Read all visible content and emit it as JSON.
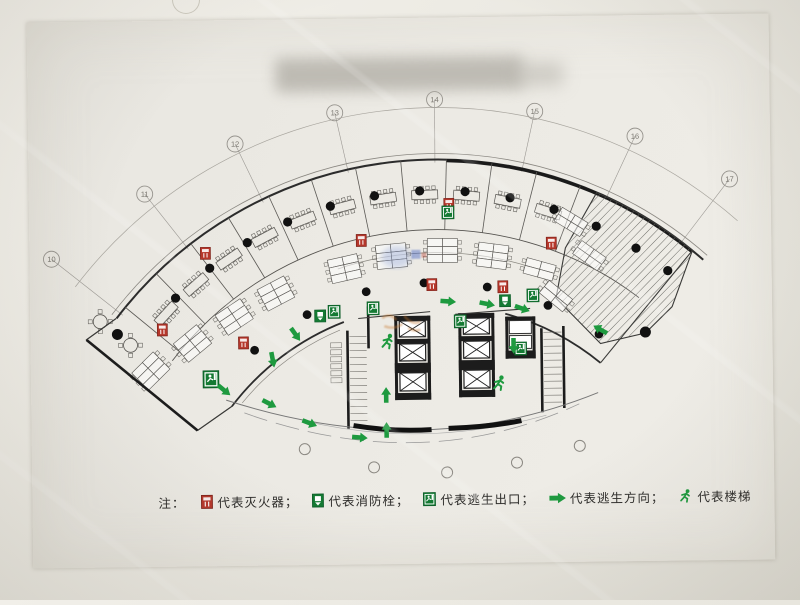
{
  "document": {
    "kind": "evacuation-floor-plan-photo",
    "title_redacted": true
  },
  "legend": {
    "note": "注：",
    "items": [
      {
        "icon": "fire-extinguisher-icon",
        "label": "代表灭火器；",
        "color": "#b5372b"
      },
      {
        "icon": "fire-hydrant-icon",
        "label": "代表消防栓；",
        "color": "#1a8a3f"
      },
      {
        "icon": "escape-exit-icon",
        "label": "代表逃生出口；",
        "color": "#1a8a3f"
      },
      {
        "icon": "escape-direction-icon",
        "label": "代表逃生方向；",
        "color": "#1e9a3f"
      },
      {
        "icon": "stairs-icon",
        "label": "代表楼梯",
        "color": "#1e9a3f"
      }
    ]
  },
  "plan": {
    "center": {
      "x": 434,
      "y": 563
    },
    "colors": {
      "line": "#4a4a4a",
      "wall": "#1c1c1c",
      "mid": "#6a6a66",
      "green": "#1e9a3f",
      "green_dark": "#147a33",
      "red": "#b5372b",
      "grid": "#9a9792",
      "watermark_orange": "#c8782e",
      "watermark_blue": "#8fa3d6"
    },
    "radii": {
      "grid_arc": 455,
      "outer_wall": 403,
      "outer_wall_outer": 409,
      "band_divider": 333,
      "spine": 310,
      "inner_wall": 258,
      "inner_wall_thin": 252,
      "columns_outer": 372,
      "columns_inner": 280
    },
    "angles": {
      "start": -52,
      "end": 42
    },
    "grid_bubbles": [
      {
        "label": "10",
        "x": 52,
        "y": 255
      },
      {
        "label": "11",
        "x": 146,
        "y": 191
      },
      {
        "label": "12",
        "x": 237,
        "y": 142
      },
      {
        "label": "13",
        "x": 337,
        "y": 112
      },
      {
        "label": "14",
        "x": 437,
        "y": 100
      },
      {
        "label": "15",
        "x": 537,
        "y": 113
      },
      {
        "label": "16",
        "x": 637,
        "y": 139
      },
      {
        "label": "17",
        "x": 731,
        "y": 183
      }
    ],
    "partition_angles": [
      -50,
      -43.5,
      -37,
      -30.5,
      -24,
      -17.5,
      -11,
      -4.5,
      2,
      8.5,
      15,
      21.5
    ],
    "meeting_angles": [
      -46.75,
      -40.25,
      -33.75,
      -27.25,
      -20.75,
      -14.25,
      -7.75,
      -1.25,
      5.25,
      11.75,
      18.25
    ],
    "outer_column_angles": [
      -44,
      -37,
      -30,
      -23,
      -16,
      -9,
      -2,
      5,
      12,
      19,
      26,
      33,
      39
    ],
    "inner_column_angles": [
      -40,
      -27,
      -14,
      -2,
      11,
      24,
      36
    ],
    "extra_columns": [
      [
        117,
        331
      ],
      [
        645,
        335
      ]
    ],
    "open_circles": [
      [
        303,
        448
      ],
      [
        372,
        467
      ],
      [
        445,
        473
      ],
      [
        515,
        464
      ],
      [
        578,
        448
      ]
    ],
    "desk_clusters": [
      {
        "x": 150,
        "y": 368,
        "rot": -44,
        "rows": 3
      },
      {
        "x": 192,
        "y": 341,
        "rot": -39,
        "rows": 3
      },
      {
        "x": 234,
        "y": 315,
        "rot": -33,
        "rows": 3
      },
      {
        "x": 276,
        "y": 292,
        "rot": -27,
        "rows": 3
      },
      {
        "x": 345,
        "y": 268,
        "rot": -12,
        "rows": 3
      },
      {
        "x": 392,
        "y": 256,
        "rot": -5,
        "rows": 3
      },
      {
        "x": 443,
        "y": 251,
        "rot": 1,
        "rows": 3
      },
      {
        "x": 493,
        "y": 257,
        "rot": 8,
        "rows": 3
      },
      {
        "x": 540,
        "y": 271,
        "rot": 16,
        "rows": 2
      },
      {
        "x": 572,
        "y": 224,
        "rot": 32,
        "rows": 2
      },
      {
        "x": 590,
        "y": 258,
        "rot": 36,
        "rows": 2
      },
      {
        "x": 556,
        "y": 298,
        "rot": 40,
        "rows": 2
      }
    ],
    "extinguishers": [
      [
        162,
        327
      ],
      [
        206,
        251
      ],
      [
        243,
        341
      ],
      [
        362,
        240
      ],
      [
        450,
        205
      ],
      [
        552,
        245
      ],
      [
        432,
        285
      ],
      [
        503,
        288
      ]
    ],
    "hydrants": [
      [
        320,
        315
      ],
      [
        505,
        302
      ]
    ],
    "exit_signs": [
      {
        "x": 210,
        "y": 377,
        "s": 1.3
      },
      {
        "x": 334,
        "y": 311,
        "s": 1
      },
      {
        "x": 373,
        "y": 308,
        "s": 1
      },
      {
        "x": 449,
        "y": 213,
        "s": 1
      },
      {
        "x": 460,
        "y": 322,
        "s": 1
      },
      {
        "x": 533,
        "y": 297,
        "s": 1
      },
      {
        "x": 520,
        "y": 350,
        "s": 1
      }
    ],
    "arrows": [
      [
        223,
        388,
        40
      ],
      [
        272,
        358,
        80
      ],
      [
        295,
        333,
        55
      ],
      [
        268,
        402,
        28
      ],
      [
        308,
        422,
        22
      ],
      [
        358,
        437,
        5
      ],
      [
        385,
        395,
        -90
      ],
      [
        385,
        430,
        -90
      ],
      [
        448,
        302,
        5
      ],
      [
        487,
        305,
        12
      ],
      [
        522,
        310,
        20
      ],
      [
        513,
        347,
        90
      ],
      [
        600,
        332,
        210
      ]
    ],
    "stair_men": [
      [
        387,
        342
      ],
      [
        498,
        385
      ]
    ],
    "elevator_boxes": [
      [
        399,
        321,
        26,
        16
      ],
      [
        399,
        344,
        26,
        17
      ],
      [
        399,
        373,
        26,
        18
      ],
      [
        463,
        319,
        26,
        16
      ],
      [
        463,
        342,
        26,
        17
      ],
      [
        463,
        371,
        26,
        18
      ]
    ],
    "shaft_boxes": [
      [
        509,
        322,
        22,
        13
      ],
      [
        509,
        337,
        22,
        13
      ]
    ],
    "black_rects": [
      [
        394,
        316,
        36,
        5
      ],
      [
        394,
        339,
        36,
        5
      ],
      [
        394,
        363,
        36,
        10
      ],
      [
        394,
        393,
        36,
        7
      ],
      [
        394,
        316,
        3,
        84
      ],
      [
        427,
        316,
        3,
        84
      ],
      [
        458,
        314,
        36,
        5
      ],
      [
        458,
        337,
        36,
        5
      ],
      [
        458,
        361,
        36,
        10
      ],
      [
        458,
        391,
        36,
        7
      ],
      [
        458,
        314,
        3,
        84
      ],
      [
        491,
        314,
        3,
        84
      ],
      [
        505,
        318,
        30,
        4
      ],
      [
        505,
        352,
        30,
        8
      ],
      [
        505,
        318,
        3,
        42
      ],
      [
        532,
        318,
        3,
        42
      ]
    ],
    "bold_lines": [
      [
        347,
        330,
        347,
        428
      ],
      [
        368,
        306,
        368,
        348
      ],
      [
        541,
        330,
        541,
        414
      ],
      [
        563,
        328,
        563,
        410
      ],
      [
        86,
        336,
        196,
        428
      ]
    ],
    "thin_lines": [
      [
        358,
        318,
        430,
        312
      ],
      [
        455,
        315,
        530,
        310
      ],
      [
        116,
        315,
        86,
        336
      ],
      [
        196,
        428,
        231,
        404
      ],
      [
        693,
        254,
        600,
        365
      ]
    ],
    "stairs": [
      {
        "x1": 349,
        "x2": 366,
        "y0": 336,
        "y1": 424,
        "step": 7
      },
      {
        "x1": 543,
        "x2": 561,
        "y0": 334,
        "y1": 408,
        "step": 7
      }
    ],
    "tread_stack": {
      "x": 330,
      "y": 342,
      "w": 11,
      "h": 5,
      "n": 6,
      "gap": 7
    },
    "hatch_path": "M598,195 A403,403 0 0 1 693,254 L672,310 L645,336 L600,346 L556,300 L566,250 Z",
    "facade_paths": [
      {
        "d": "M225,398 Q420,464 597,395",
        "c": "#777",
        "w": 1,
        "dash": ""
      },
      {
        "d": "M243,411 Q420,477 578,406",
        "c": "#999",
        "w": 0.8,
        "dash": "24 9"
      },
      {
        "d": "M300,419 Q420,450 545,417",
        "c": "#aaa",
        "w": 0.6,
        "dash": ""
      },
      {
        "d": "M352,425 Q392,432 430,430",
        "c": "#111",
        "w": 5,
        "dash": ""
      },
      {
        "d": "M447,429 Q488,428 520,422",
        "c": "#111",
        "w": 5,
        "dash": ""
      }
    ],
    "lounge_tables": [
      [
        100,
        318
      ],
      [
        130,
        342
      ]
    ],
    "wing_outline": "M116,315 L86,336 L196,428 L231,404"
  }
}
